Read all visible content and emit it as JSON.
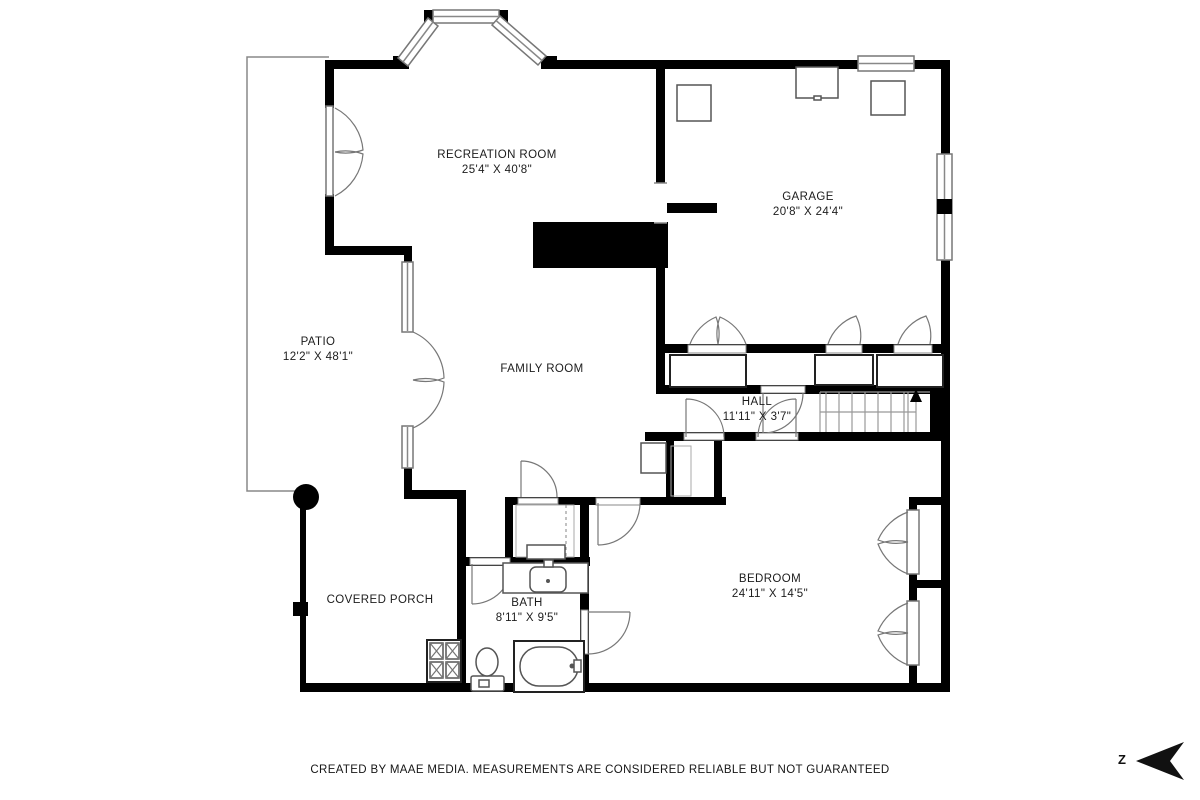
{
  "rooms": [
    {
      "id": "recreation-room",
      "name": "RECREATION ROOM",
      "dims": "25'4\" X 40'8\""
    },
    {
      "id": "garage",
      "name": "GARAGE",
      "dims": "20'8\" X 24'4\""
    },
    {
      "id": "patio",
      "name": "PATIO",
      "dims": "12'2\" X 48'1\""
    },
    {
      "id": "family-room",
      "name": "FAMILY ROOM",
      "dims": ""
    },
    {
      "id": "hall",
      "name": "HALL",
      "dims": "11'11\" X 3'7\""
    },
    {
      "id": "bedroom",
      "name": "BEDROOM",
      "dims": "24'11\" X 14'5\""
    },
    {
      "id": "bath",
      "name": "BATH",
      "dims": "8'11\" X 9'5\""
    },
    {
      "id": "covered-porch",
      "name": "COVERED PORCH",
      "dims": ""
    }
  ],
  "footer": {
    "disclaimer": "CREATED BY MAAE MEDIA. MEASUREMENTS ARE CONSIDERED RELIABLE BUT NOT GUARANTEED"
  },
  "compass": {
    "letter": "Z"
  },
  "colors": {
    "wall": "#000000",
    "symbol_line": "#777777",
    "thin_line": "#888888",
    "text": "#1c1c1c",
    "background": "#ffffff"
  }
}
